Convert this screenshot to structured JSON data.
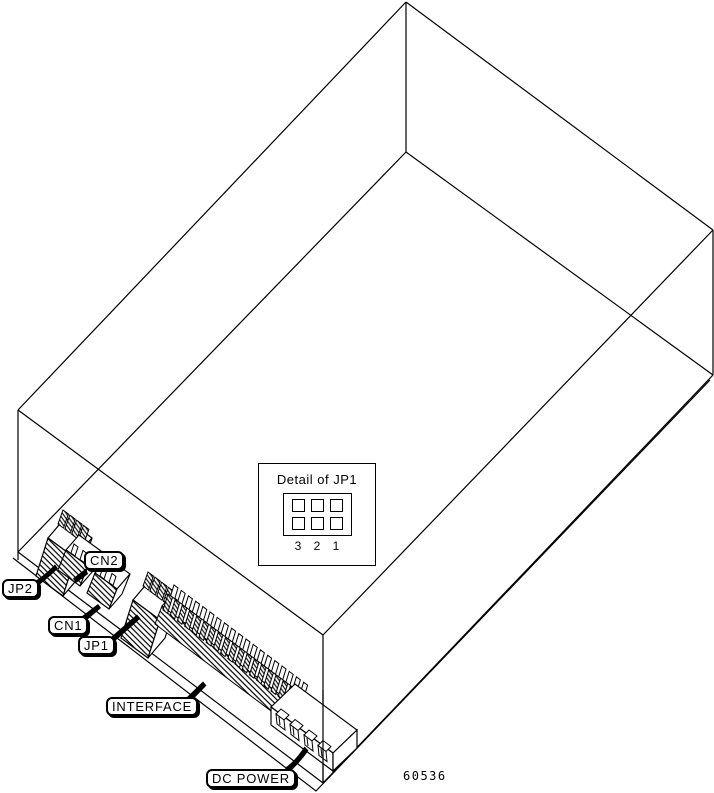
{
  "diagram": {
    "description": "Isometric line drawing of a hard disk drive showing rear-edge connectors",
    "part_number": "60536",
    "callouts": [
      {
        "id": "jp2",
        "label": "JP2"
      },
      {
        "id": "cn2",
        "label": "CN2"
      },
      {
        "id": "cn1",
        "label": "CN1"
      },
      {
        "id": "jp1",
        "label": "JP1"
      },
      {
        "id": "interface",
        "label": "INTERFACE"
      },
      {
        "id": "dc_power",
        "label": "DC POWER"
      }
    ],
    "detail_inset": {
      "title": "Detail of JP1",
      "jumper_grid": {
        "rows": 2,
        "cols": 3
      },
      "pin_numbers": [
        "3",
        "2",
        "1"
      ]
    },
    "colors": {
      "line": "#000000",
      "background": "#ffffff"
    }
  }
}
